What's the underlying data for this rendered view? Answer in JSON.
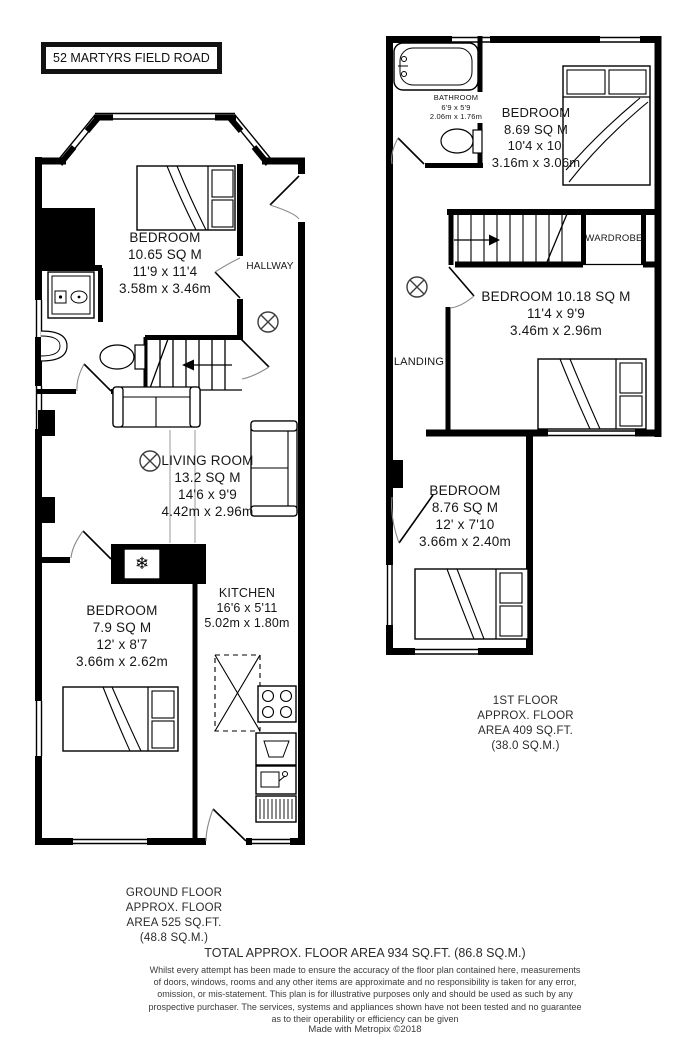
{
  "title": "52 MARTYRS FIELD ROAD",
  "icons": {
    "freezer": "❄"
  },
  "ground_floor": {
    "bedroom_front": [
      "BEDROOM",
      "10.65 SQ M",
      "11'9 x 11'4",
      "3.58m x 3.46m"
    ],
    "hallway": "HALLWAY",
    "living_room": [
      "LIVING ROOM",
      "13.2 SQ M",
      "14'6 x 9'9",
      "4.42m x 2.96m"
    ],
    "kitchen": [
      "KITCHEN",
      "16'6 x 5'11",
      "5.02m x 1.80m"
    ],
    "bedroom_rear": [
      "BEDROOM",
      "7.9 SQ M",
      "12' x 8'7",
      "3.66m x 2.62m"
    ],
    "summary": [
      "GROUND FLOOR",
      "APPROX. FLOOR",
      "AREA 525 SQ.FT.",
      "(48.8 SQ.M.)"
    ]
  },
  "first_floor": {
    "bathroom": [
      "BATHROOM",
      "6'9 x 5'9",
      "2.06m x 1.76m"
    ],
    "bedroom_top": [
      "BEDROOM",
      "8.69 SQ M",
      "10'4 x 10'",
      "3.16m x 3.06m"
    ],
    "wardrobe": "WARDROBE",
    "landing": "LANDING",
    "bedroom_middle": [
      "BEDROOM 10.18 SQ M",
      "11'4 x 9'9",
      "3.46m x 2.96m"
    ],
    "bedroom_bottom": [
      "BEDROOM",
      "8.76 SQ M",
      "12' x 7'10",
      "3.66m x 2.40m"
    ],
    "summary": [
      "1ST FLOOR",
      "APPROX. FLOOR",
      "AREA 409 SQ.FT.",
      "(38.0 SQ.M.)"
    ]
  },
  "footer": {
    "total": "TOTAL APPROX. FLOOR AREA 934 SQ.FT. (86.8 SQ.M.)",
    "disclaimer": [
      "Whilst every attempt has been made to ensure the accuracy of the floor plan contained here, measurements",
      "of doors, windows, rooms and any other items are approximate and no responsibility is taken for any error,",
      "omission, or mis-statement. This plan is for illustrative purposes only and should be used as such by any",
      "prospective purchaser. The services, systems and appliances shown have not been tested and no guarantee",
      "as to their operability or efficiency can be given"
    ],
    "credit": "Made with Metropix ©2018"
  }
}
